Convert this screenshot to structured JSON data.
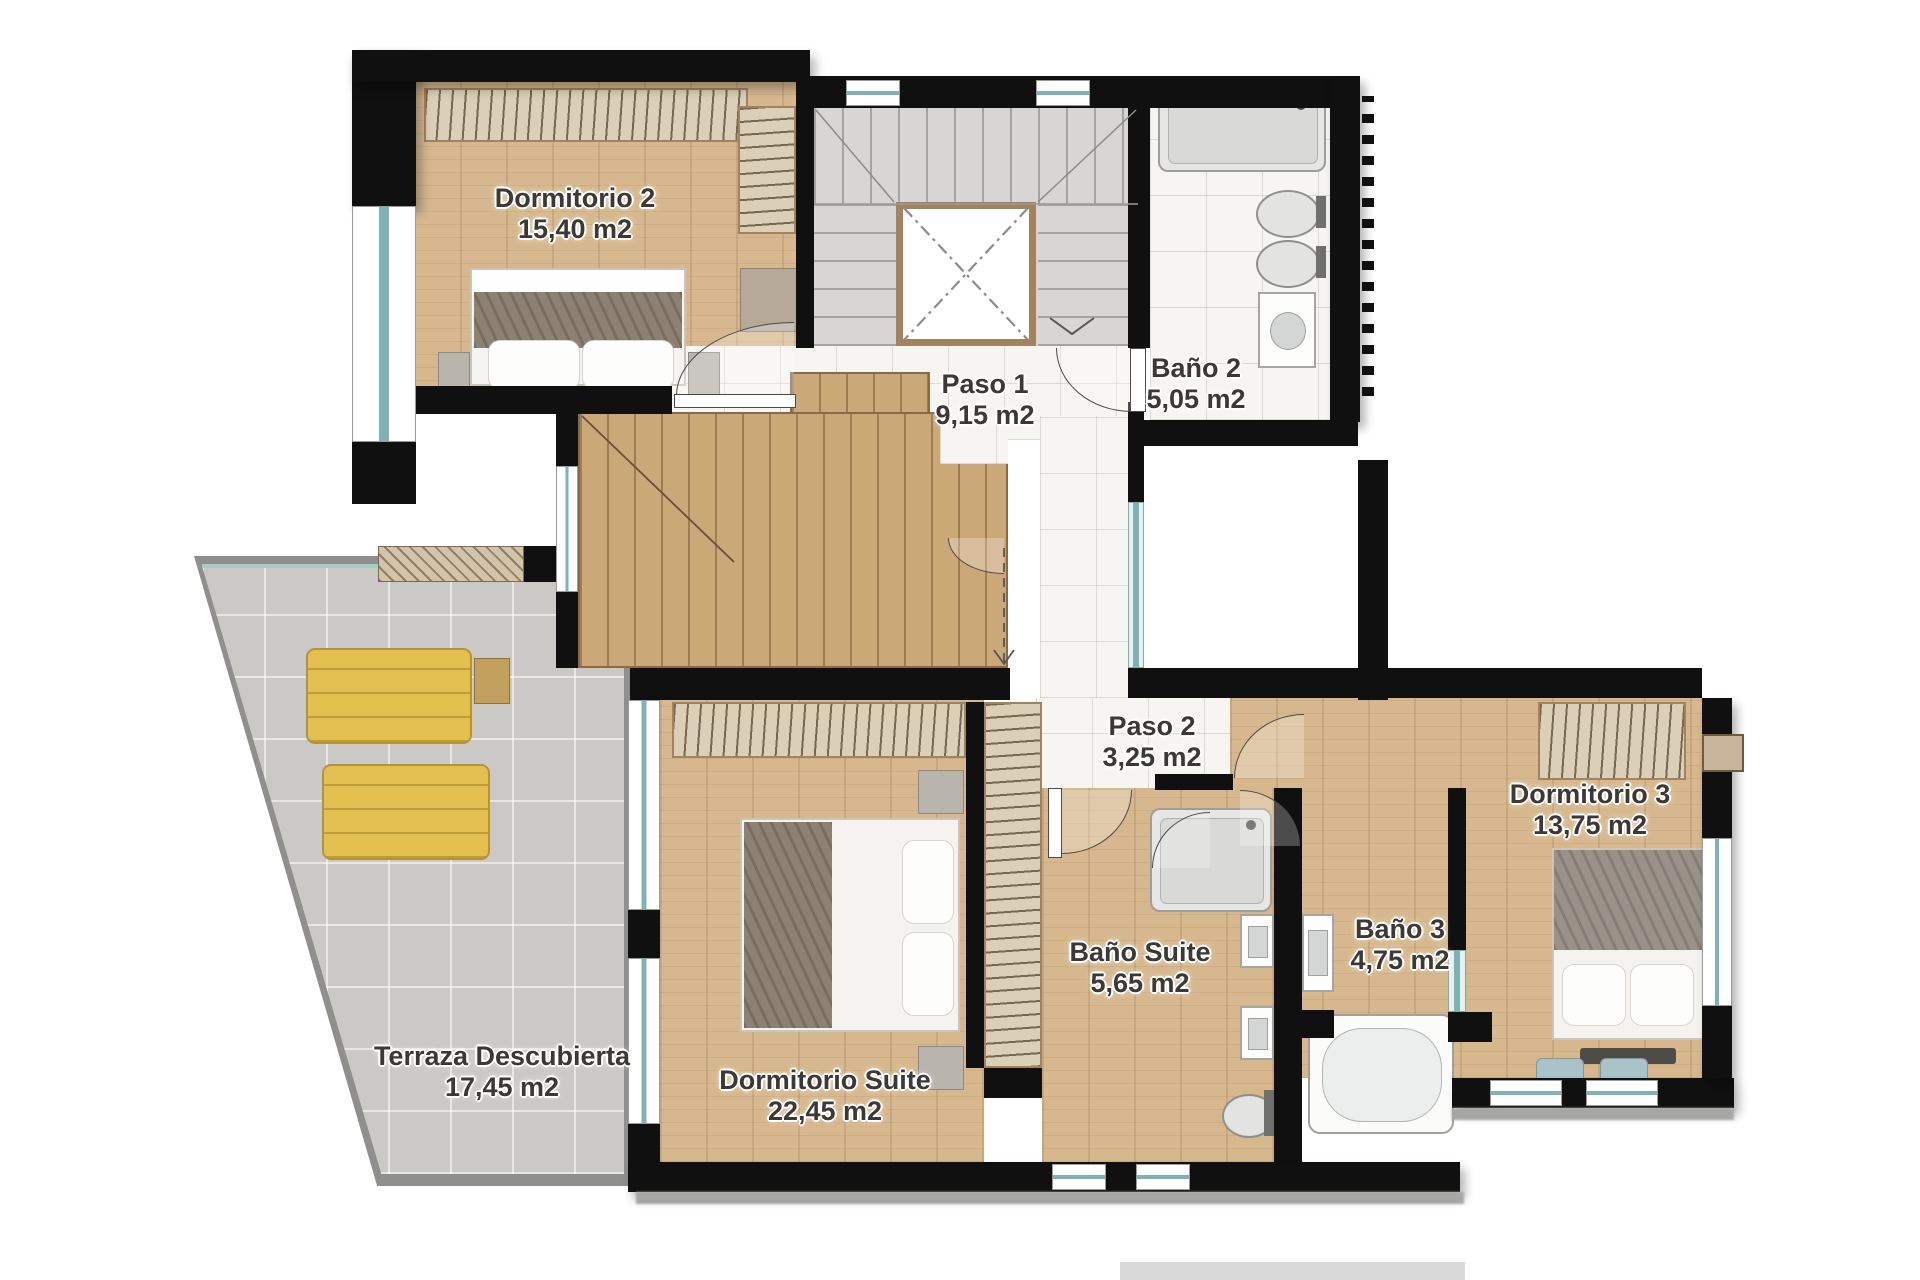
{
  "palette": {
    "wall": "#101010",
    "wood": "#d7b88e",
    "woodStair": "#cba878",
    "marble": "#f6f5f2",
    "grayStep": "#d7d6d4",
    "terrace": "#cac9c6",
    "hatch": "#dbcfb8",
    "teal": "#7fb2b5",
    "lounger": "#e2bf4e",
    "labelInk": "#3c3835"
  },
  "rooms": [
    {
      "id": "dormitorio-2",
      "name": "Dormitorio 2",
      "area": "15,40 m2"
    },
    {
      "id": "paso-1",
      "name": "Paso 1",
      "area": "9,15 m2"
    },
    {
      "id": "bano-2",
      "name": "Baño 2",
      "area": "5,05 m2"
    },
    {
      "id": "paso-2",
      "name": "Paso 2",
      "area": "3,25 m2"
    },
    {
      "id": "dormitorio-3",
      "name": "Dormitorio 3",
      "area": "13,75 m2"
    },
    {
      "id": "bano-3",
      "name": "Baño 3",
      "area": "4,75 m2"
    },
    {
      "id": "bano-suite",
      "name": "Baño Suite",
      "area": "5,65 m2"
    },
    {
      "id": "dormitorio-suite",
      "name": "Dormitorio Suite",
      "area": "22,45 m2"
    },
    {
      "id": "terraza",
      "name": "Terraza Descubierta",
      "area": "17,45 m2"
    }
  ]
}
